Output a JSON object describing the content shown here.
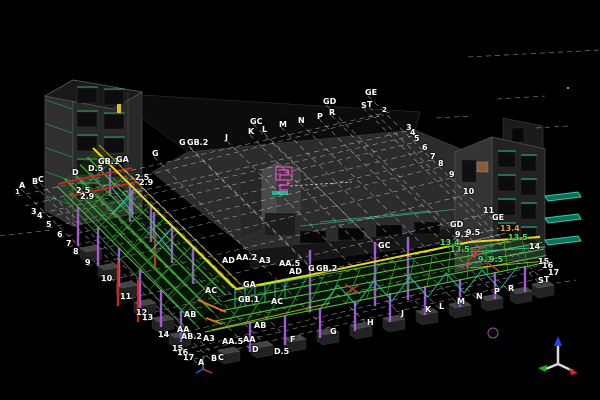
{
  "view": {
    "type": "3d-structural-model-viewport",
    "background": "#000000"
  },
  "colors": {
    "steel_beam_green": "#4ec43e",
    "fascia_yellow": "#e8d820",
    "column_purple": "#a45ad8",
    "brace_teal": "#2ec4b0",
    "member_red": "#cc2626",
    "member_orange": "#e07820",
    "grid_line_white": "#ffffff",
    "stair_magenta": "#e040c0",
    "balcony_teal": "#2ed0b0",
    "axis_x_red": "#dd2222",
    "axis_y_green": "#22aa22",
    "axis_z_blue": "#2244ee",
    "label_default": "#ffffff",
    "label_green": "#44e070",
    "label_orange": "#e0a040"
  },
  "grid_labels": [
    {
      "t": "GC",
      "x": 250,
      "y": 122
    },
    {
      "t": "J",
      "x": 225,
      "y": 138
    },
    {
      "t": "K",
      "x": 248,
      "y": 132
    },
    {
      "t": "L",
      "x": 262,
      "y": 130
    },
    {
      "t": "M",
      "x": 279,
      "y": 125
    },
    {
      "t": "N",
      "x": 298,
      "y": 121
    },
    {
      "t": "P",
      "x": 317,
      "y": 117
    },
    {
      "t": "R",
      "x": 329,
      "y": 113
    },
    {
      "t": "GD",
      "x": 323,
      "y": 102
    },
    {
      "t": "GE",
      "x": 365,
      "y": 93
    },
    {
      "t": "S",
      "x": 361,
      "y": 106
    },
    {
      "t": "T",
      "x": 367,
      "y": 105
    },
    {
      "t": "2",
      "x": 382,
      "y": 111,
      "s": 7
    },
    {
      "t": "3",
      "x": 406,
      "y": 128
    },
    {
      "t": "4",
      "x": 410,
      "y": 133
    },
    {
      "t": "5",
      "x": 414,
      "y": 139
    },
    {
      "t": "6",
      "x": 422,
      "y": 148
    },
    {
      "t": "7",
      "x": 430,
      "y": 157
    },
    {
      "t": "8",
      "x": 438,
      "y": 164
    },
    {
      "t": "9",
      "x": 449,
      "y": 175
    },
    {
      "t": "10",
      "x": 463,
      "y": 192
    },
    {
      "t": "11",
      "x": 483,
      "y": 211
    },
    {
      "t": "GE",
      "x": 492,
      "y": 218
    },
    {
      "t": "GD",
      "x": 450,
      "y": 225
    },
    {
      "t": "9.1",
      "x": 455,
      "y": 235
    },
    {
      "t": "9.5",
      "x": 466,
      "y": 233
    },
    {
      "t": "13.4",
      "x": 440,
      "y": 243,
      "c": "g"
    },
    {
      "t": "13.5",
      "x": 450,
      "y": 250,
      "c": "g"
    },
    {
      "t": "13.4",
      "x": 500,
      "y": 229,
      "c": "o"
    },
    {
      "t": "13.5",
      "x": 508,
      "y": 238,
      "c": "g"
    },
    {
      "t": "14",
      "x": 529,
      "y": 247
    },
    {
      "t": "9.1",
      "x": 478,
      "y": 260,
      "c": "g"
    },
    {
      "t": "9.5",
      "x": 489,
      "y": 260,
      "c": "g"
    },
    {
      "t": "15",
      "x": 538,
      "y": 262
    },
    {
      "t": "16",
      "x": 542,
      "y": 266
    },
    {
      "t": "17",
      "x": 548,
      "y": 273
    },
    {
      "t": "S",
      "x": 538,
      "y": 281
    },
    {
      "t": "T",
      "x": 544,
      "y": 280
    },
    {
      "t": "J",
      "x": 401,
      "y": 314
    },
    {
      "t": "K",
      "x": 425,
      "y": 310
    },
    {
      "t": "L",
      "x": 439,
      "y": 307
    },
    {
      "t": "M",
      "x": 457,
      "y": 302
    },
    {
      "t": "N",
      "x": 476,
      "y": 297
    },
    {
      "t": "P",
      "x": 494,
      "y": 292
    },
    {
      "t": "R",
      "x": 508,
      "y": 289
    },
    {
      "t": "H",
      "x": 367,
      "y": 323
    },
    {
      "t": "G",
      "x": 330,
      "y": 332
    },
    {
      "t": "F",
      "x": 290,
      "y": 340
    },
    {
      "t": "D.5",
      "x": 274,
      "y": 352
    },
    {
      "t": "D",
      "x": 252,
      "y": 350
    },
    {
      "t": "C",
      "x": 218,
      "y": 358
    },
    {
      "t": "B",
      "x": 211,
      "y": 359
    },
    {
      "t": "A",
      "x": 198,
      "y": 363
    },
    {
      "t": "AA",
      "x": 243,
      "y": 340
    },
    {
      "t": "AA.5",
      "x": 222,
      "y": 342
    },
    {
      "t": "A3",
      "x": 203,
      "y": 339
    },
    {
      "t": "AB",
      "x": 254,
      "y": 326
    },
    {
      "t": "AB",
      "x": 184,
      "y": 315
    },
    {
      "t": "AA",
      "x": 177,
      "y": 330
    },
    {
      "t": "AB.2",
      "x": 181,
      "y": 337
    },
    {
      "t": "15",
      "x": 172,
      "y": 349
    },
    {
      "t": "16",
      "x": 177,
      "y": 353
    },
    {
      "t": "17",
      "x": 183,
      "y": 358
    },
    {
      "t": "14",
      "x": 158,
      "y": 335
    },
    {
      "t": "12",
      "x": 136,
      "y": 313
    },
    {
      "t": "13",
      "x": 142,
      "y": 318
    },
    {
      "t": "11",
      "x": 120,
      "y": 297
    },
    {
      "t": "10",
      "x": 101,
      "y": 279
    },
    {
      "t": "9",
      "x": 85,
      "y": 263
    },
    {
      "t": "8",
      "x": 73,
      "y": 252
    },
    {
      "t": "7",
      "x": 66,
      "y": 244
    },
    {
      "t": "6",
      "x": 57,
      "y": 235
    },
    {
      "t": "5",
      "x": 46,
      "y": 225
    },
    {
      "t": "4",
      "x": 37,
      "y": 216
    },
    {
      "t": "3",
      "x": 31,
      "y": 212
    },
    {
      "t": "1",
      "x": 15,
      "y": 193,
      "s": 7
    },
    {
      "t": "A",
      "x": 19,
      "y": 186
    },
    {
      "t": "B",
      "x": 32,
      "y": 182
    },
    {
      "t": "C",
      "x": 38,
      "y": 180
    },
    {
      "t": "D",
      "x": 72,
      "y": 173
    },
    {
      "t": "D.5",
      "x": 88,
      "y": 169
    },
    {
      "t": "GB.1",
      "x": 98,
      "y": 162
    },
    {
      "t": "GA",
      "x": 116,
      "y": 160
    },
    {
      "t": "2.5",
      "x": 76,
      "y": 191
    },
    {
      "t": "2.9",
      "x": 80,
      "y": 197
    },
    {
      "t": "2.5",
      "x": 135,
      "y": 178
    },
    {
      "t": "2.9",
      "x": 139,
      "y": 183
    },
    {
      "t": "G",
      "x": 152,
      "y": 154
    },
    {
      "t": "G",
      "x": 179,
      "y": 143
    },
    {
      "t": "GB.2",
      "x": 187,
      "y": 143
    },
    {
      "t": "AD",
      "x": 222,
      "y": 261
    },
    {
      "t": "AA.2",
      "x": 236,
      "y": 258
    },
    {
      "t": "A3",
      "x": 259,
      "y": 261
    },
    {
      "t": "AA.5",
      "x": 279,
      "y": 264
    },
    {
      "t": "AD",
      "x": 289,
      "y": 272
    },
    {
      "t": "G",
      "x": 308,
      "y": 269
    },
    {
      "t": "GB.2",
      "x": 316,
      "y": 269
    },
    {
      "t": "GA",
      "x": 243,
      "y": 285
    },
    {
      "t": "GB.1",
      "x": 238,
      "y": 300
    },
    {
      "t": "AC",
      "x": 271,
      "y": 302
    },
    {
      "t": "AC",
      "x": 205,
      "y": 291
    },
    {
      "t": "GC",
      "x": 378,
      "y": 246
    }
  ]
}
